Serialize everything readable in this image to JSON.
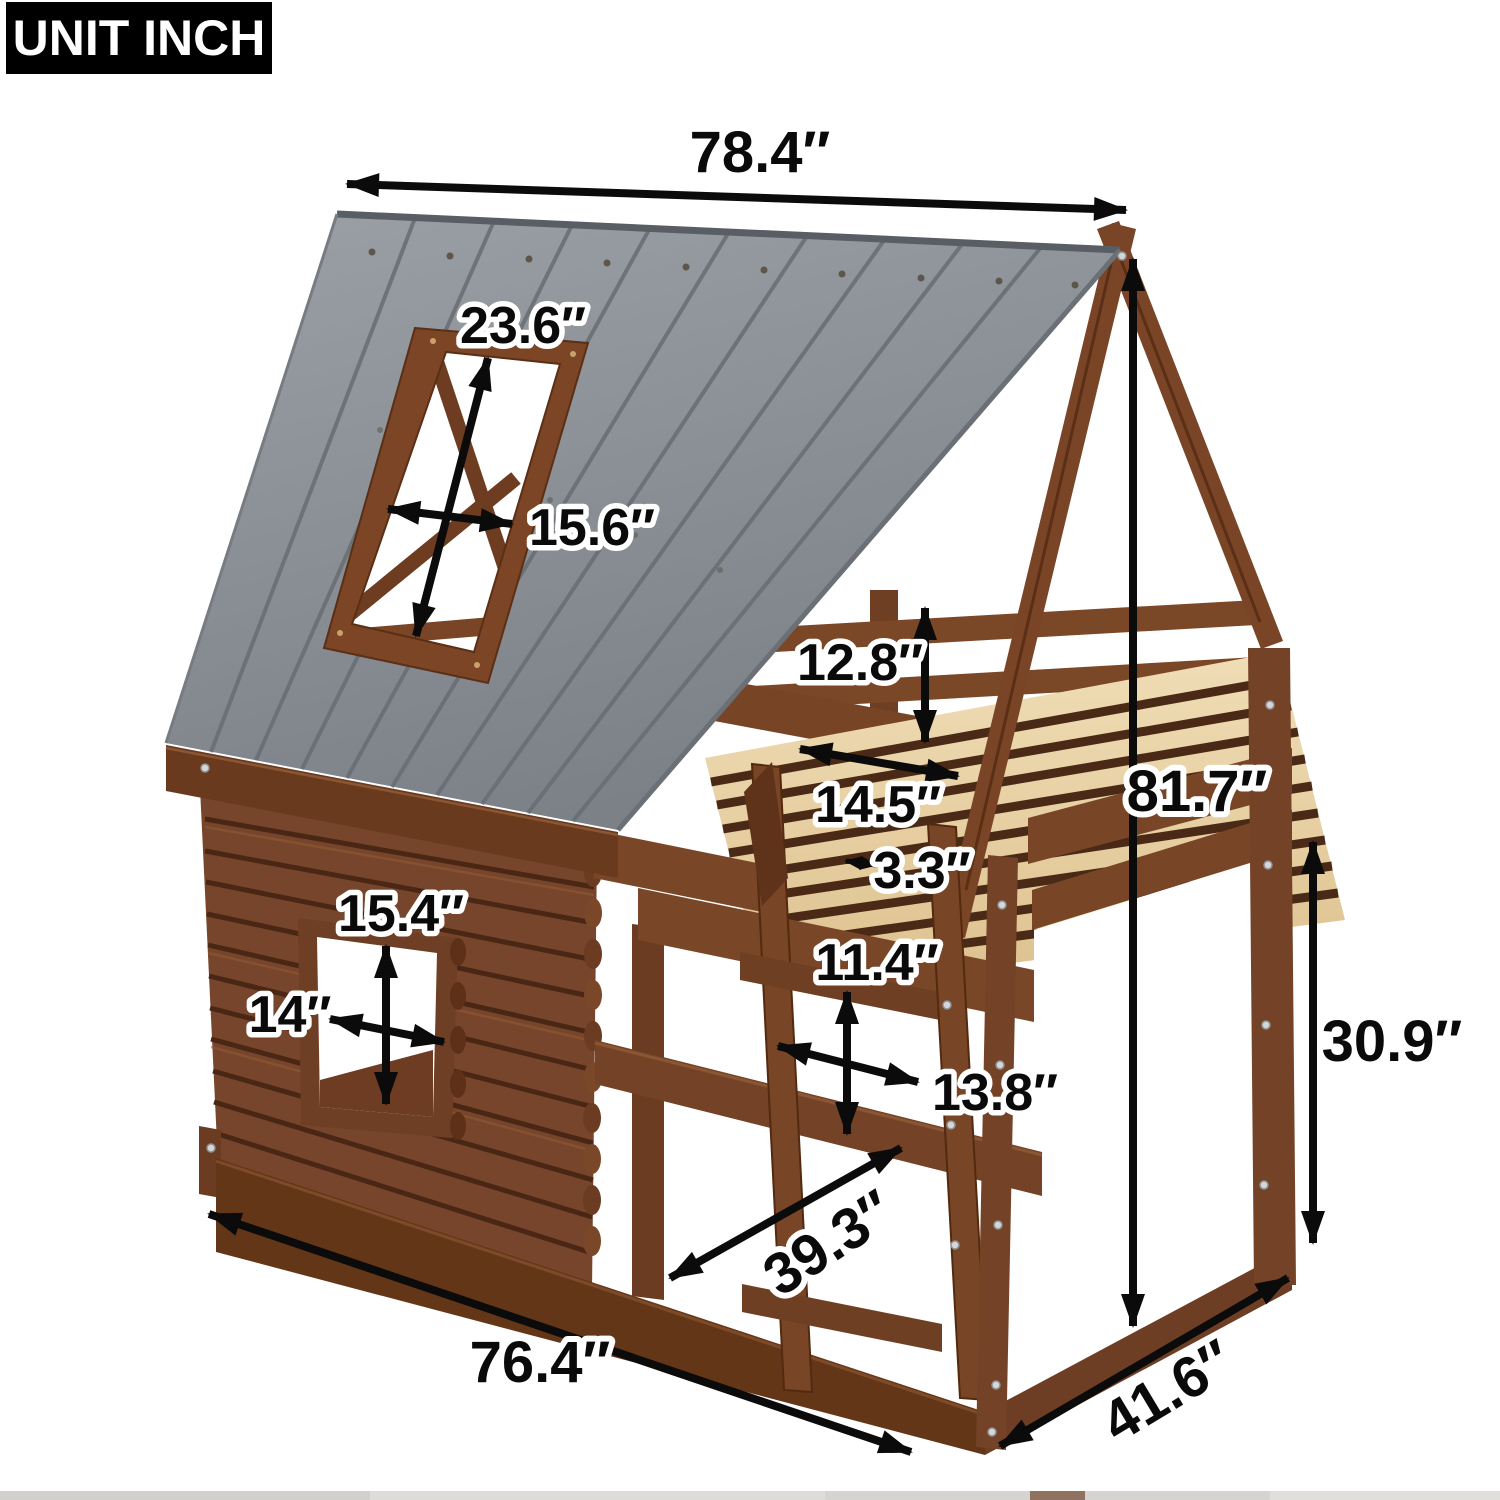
{
  "unit_badge": "UNIT INCH",
  "annotations": [
    {
      "name": "roof-width",
      "value": "78.4″"
    },
    {
      "name": "roof-window-height",
      "value": "23.6″"
    },
    {
      "name": "roof-window-width",
      "value": "15.6″"
    },
    {
      "name": "guardrail-height",
      "value": "12.8″"
    },
    {
      "name": "headboard-width",
      "value": "14.5″"
    },
    {
      "name": "slat-gap",
      "value": "3.3″"
    },
    {
      "name": "total-height",
      "value": "81.7″"
    },
    {
      "name": "wall-window-height",
      "value": "15.4″"
    },
    {
      "name": "wall-window-width",
      "value": "14″"
    },
    {
      "name": "ladder-rung-spacing",
      "value": "11.4″"
    },
    {
      "name": "ladder-width",
      "value": "13.8″"
    },
    {
      "name": "under-bed-clearance",
      "value": "30.9″"
    },
    {
      "name": "ladder-length",
      "value": "39.3″"
    },
    {
      "name": "base-length",
      "value": "76.4″"
    },
    {
      "name": "base-depth",
      "value": "41.6″"
    }
  ],
  "colors": {
    "background": "#ffffff",
    "badge_bg": "#000000",
    "badge_text": "#ffffff",
    "dimension_ink": "#0b0b0b",
    "roof_gray": "#8b9095",
    "wood_brown": "#74432a",
    "wood_dark": "#5a3018",
    "slat_wood": "#e9d4ac"
  }
}
